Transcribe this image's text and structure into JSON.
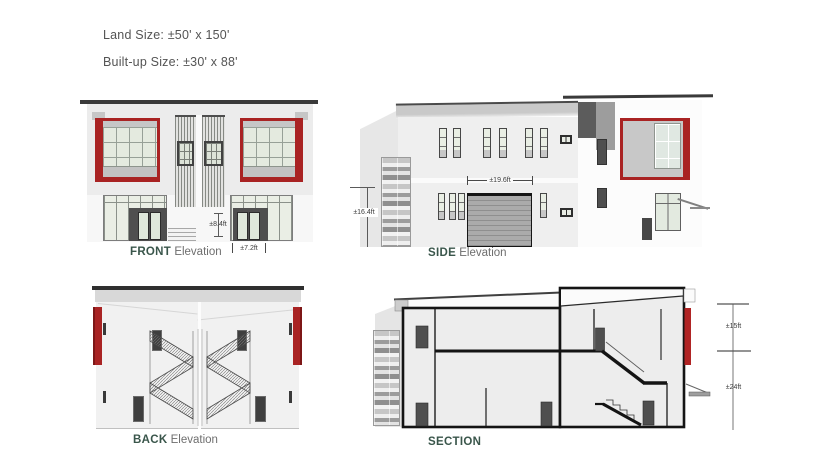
{
  "header": {
    "land_size": "Land Size: ±50' x 150'",
    "built_up_size": "Built-up Size: ±30' x 88'"
  },
  "views": {
    "front": {
      "name": "FRONT",
      "type_label": "Elevation",
      "dims": {
        "entry_height": "±8.4ft",
        "door_width": "±7.2ft"
      }
    },
    "side": {
      "name": "SIDE",
      "type_label": "Elevation",
      "dims": {
        "left_height": "±16.4ft",
        "garage_width": "±19.6ft"
      }
    },
    "back": {
      "name": "BACK",
      "type_label": "Elevation"
    },
    "section": {
      "name": "SECTION",
      "dims": {
        "upper": "±15ft",
        "lower": "±24ft"
      }
    }
  },
  "colors": {
    "accent_red": "#a92323",
    "label_green": "#3a564b",
    "header_text_gray": "#545454",
    "dim_text": "#3c3c3c",
    "roof_line": "#3a3a3a",
    "facade_gray": "#ececec",
    "glass_green": "#e4eadf",
    "panel_dark": "#4f4f4f"
  }
}
